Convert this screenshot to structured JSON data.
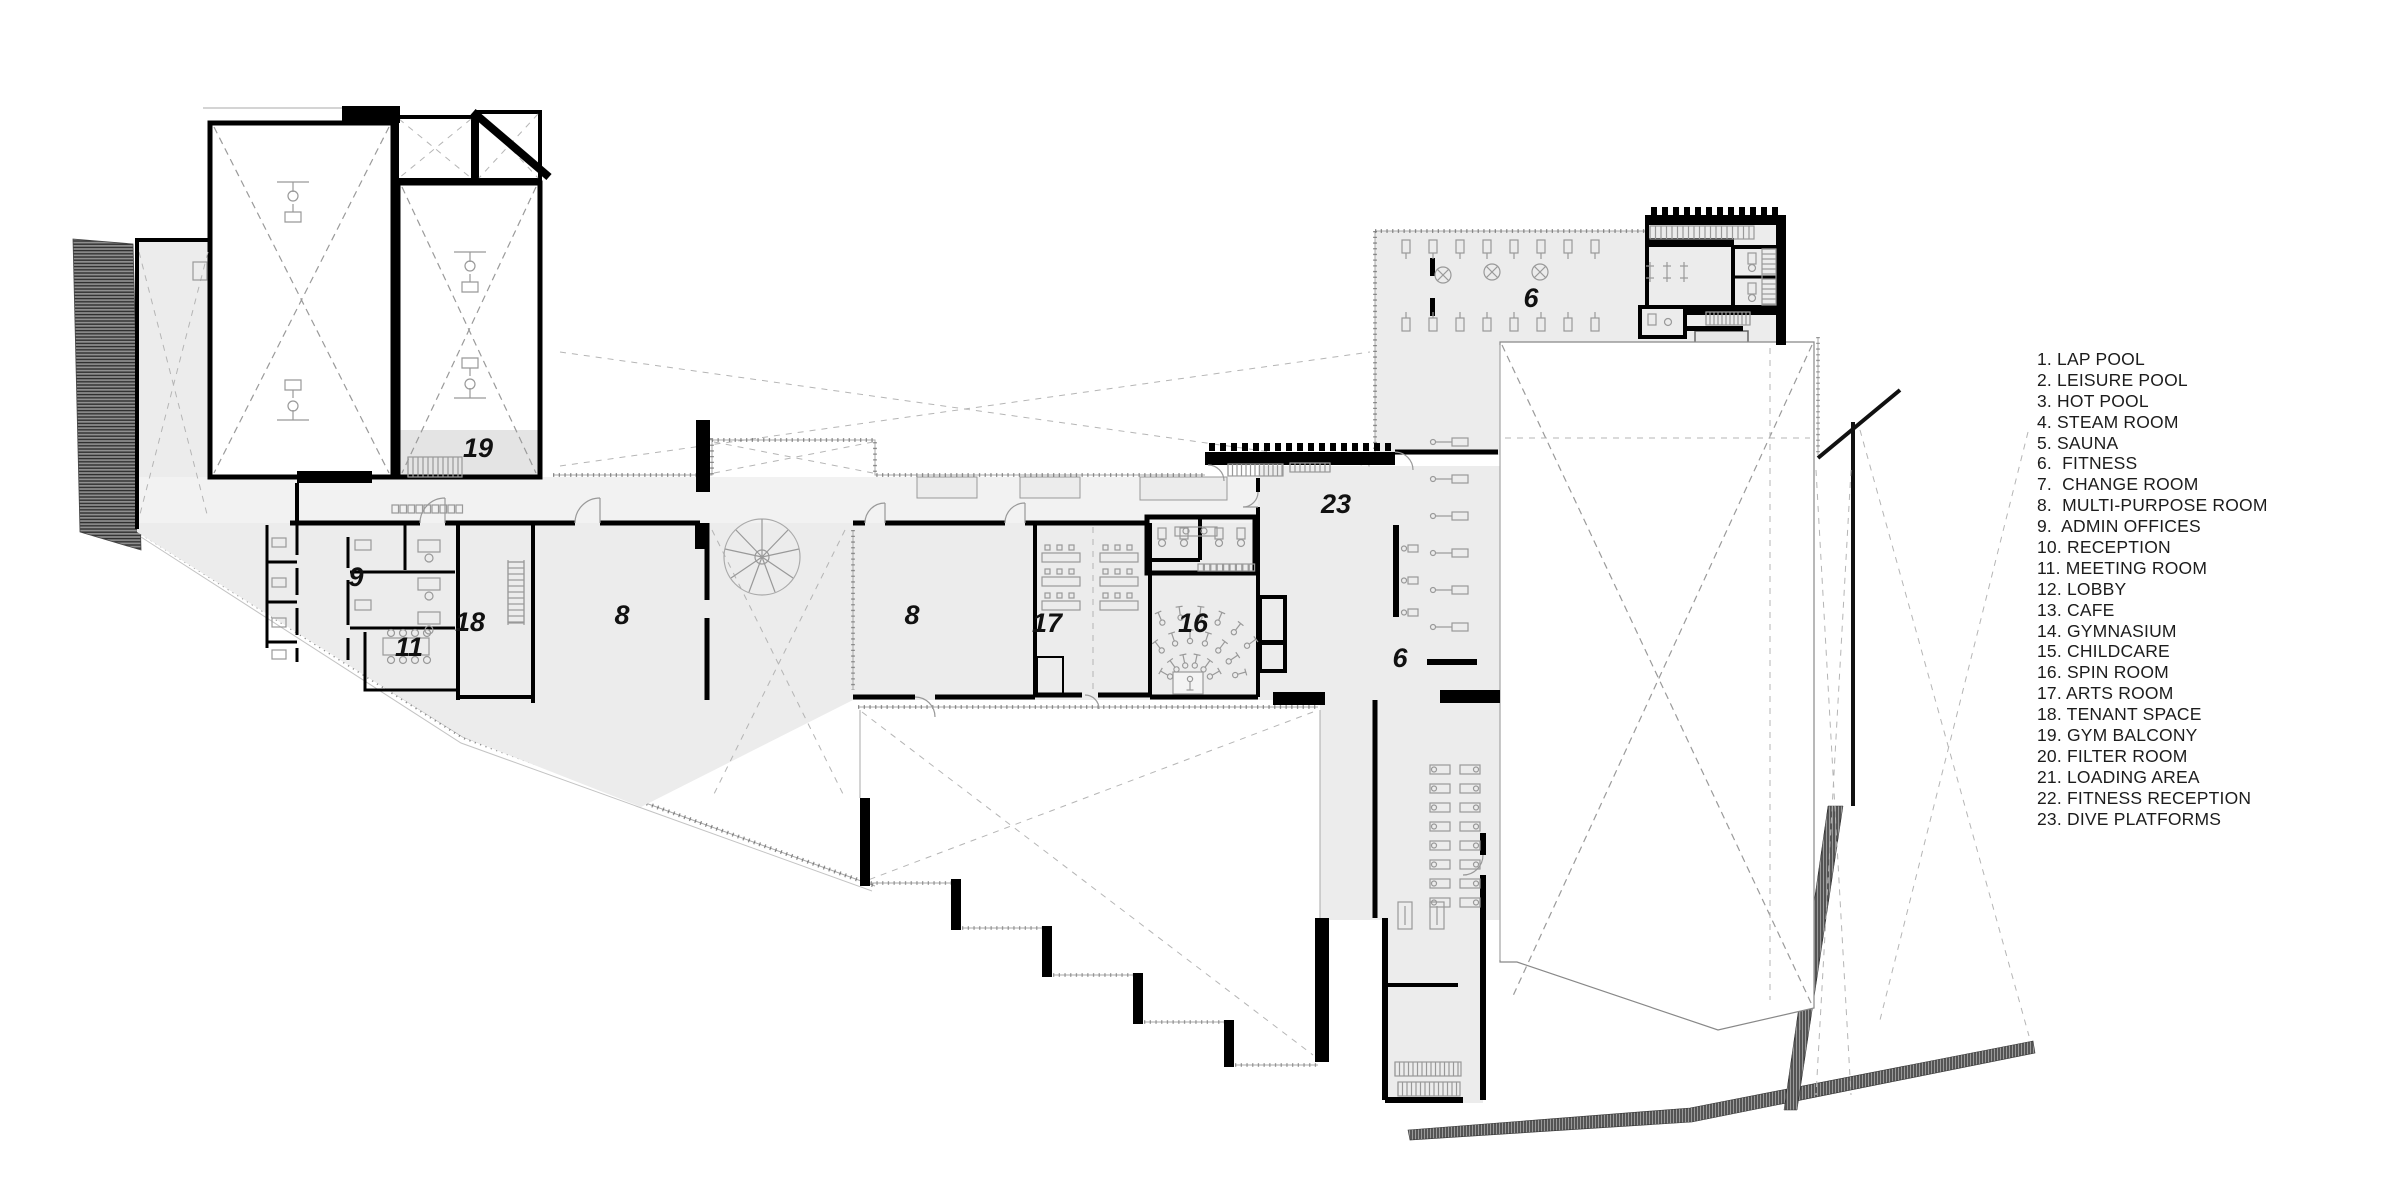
{
  "title": "Recreation centre floor plan",
  "colors": {
    "background": "#ffffff",
    "wall": "#000000",
    "floor": "#ececec",
    "corridor_floor": "#f2f2f2",
    "balcony_floor": "#e4e4e4",
    "void_dash": "#9a9a9a",
    "site_hatch": "#3d3d3d",
    "fixture": "#999999",
    "label_text": "#111111",
    "legend_text": "#1c1c1c"
  },
  "legend": {
    "items": [
      "1. LAP POOL",
      "2. LEISURE POOL",
      "3. HOT POOL",
      "4. STEAM ROOM",
      "5. SAUNA",
      "6.  FITNESS",
      "7.  CHANGE ROOM",
      "8.  MULTI-PURPOSE ROOM",
      "9.  ADMIN OFFICES",
      "10. RECEPTION",
      "11. MEETING ROOM",
      "12. LOBBY",
      "13. CAFE",
      "14. GYMNASIUM",
      "15. CHILDCARE",
      "16. SPIN ROOM",
      "17. ARTS ROOM",
      "18. TENANT SPACE",
      "19. GYM BALCONY",
      "20. FILTER ROOM",
      "21. LOADING AREA",
      "22. FITNESS RECEPTION",
      "23. DIVE PLATFORMS"
    ]
  },
  "plan": {
    "room_labels": [
      {
        "number": "19",
        "x": 478,
        "y": 457
      },
      {
        "number": "9",
        "x": 356,
        "y": 586
      },
      {
        "number": "11",
        "x": 409,
        "y": 656
      },
      {
        "number": "18",
        "x": 470,
        "y": 631
      },
      {
        "number": "8",
        "x": 622,
        "y": 624
      },
      {
        "number": "8",
        "x": 912,
        "y": 624
      },
      {
        "number": "17",
        "x": 1047,
        "y": 632
      },
      {
        "number": "16",
        "x": 1193,
        "y": 632
      },
      {
        "number": "23",
        "x": 1336,
        "y": 513
      },
      {
        "number": "6",
        "x": 1400,
        "y": 667
      },
      {
        "number": "6",
        "x": 1531,
        "y": 307
      }
    ]
  }
}
